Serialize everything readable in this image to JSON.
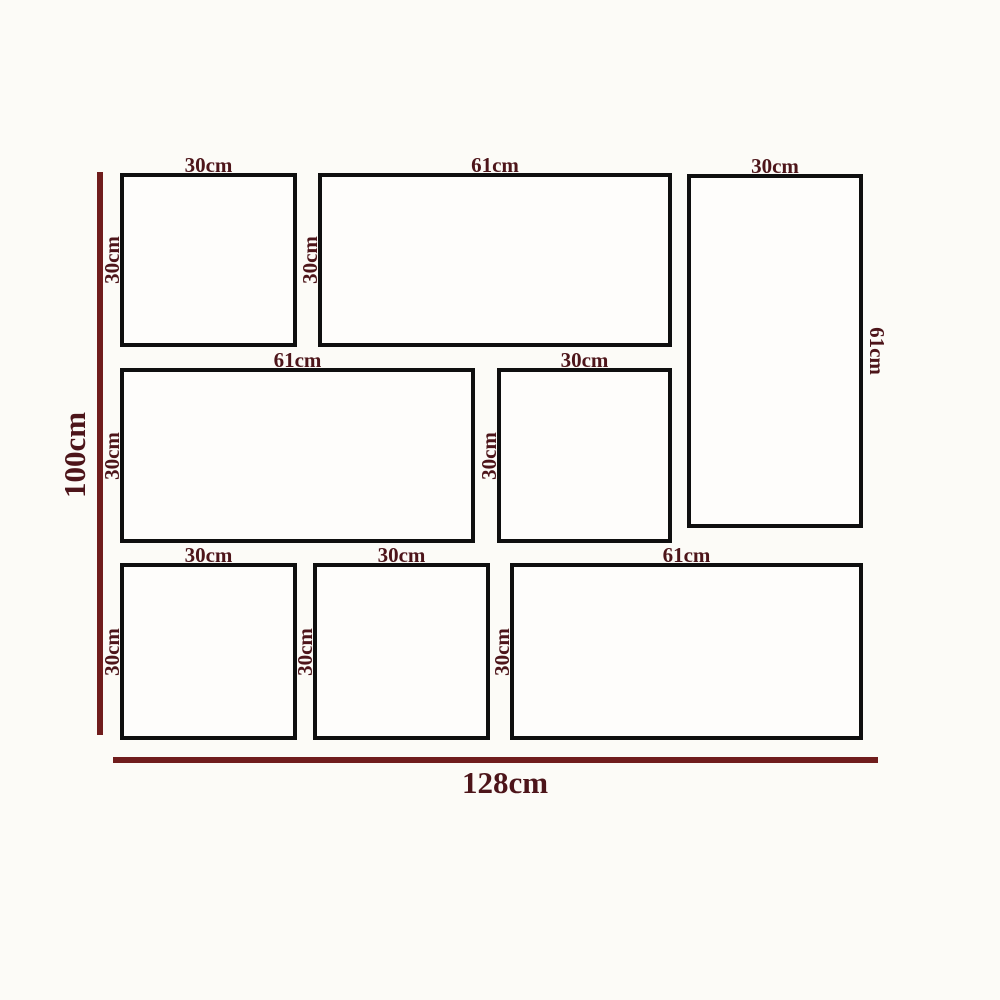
{
  "diagram_type": "panel-layout-dimension-diagram",
  "colors": {
    "label_text": "#4d151a",
    "dimension_line": "#701d1d",
    "panel_border": "#0f0f0f",
    "background": "#fcfbf7"
  },
  "overall": {
    "total_height_label": "100cm",
    "total_width_label": "128cm",
    "total_height_cm": 100,
    "total_width_cm": 128
  },
  "panels": [
    {
      "width_label": "30cm",
      "height_label": "30cm",
      "width_cm": 30,
      "height_cm": 30
    },
    {
      "width_label": "61cm",
      "height_label": "30cm",
      "width_cm": 61,
      "height_cm": 30
    },
    {
      "width_label": "30cm",
      "height_label": "61cm",
      "width_cm": 30,
      "height_cm": 61
    },
    {
      "width_label": "61cm",
      "height_label": "30cm",
      "width_cm": 61,
      "height_cm": 30
    },
    {
      "width_label": "30cm",
      "height_label": "30cm",
      "width_cm": 30,
      "height_cm": 30
    },
    {
      "width_label": "30cm",
      "height_label": "30cm",
      "width_cm": 30,
      "height_cm": 30
    },
    {
      "width_label": "30cm",
      "height_label": "30cm",
      "width_cm": 30,
      "height_cm": 30
    },
    {
      "width_label": "61cm",
      "height_label": "30cm",
      "width_cm": 61,
      "height_cm": 30
    }
  ]
}
